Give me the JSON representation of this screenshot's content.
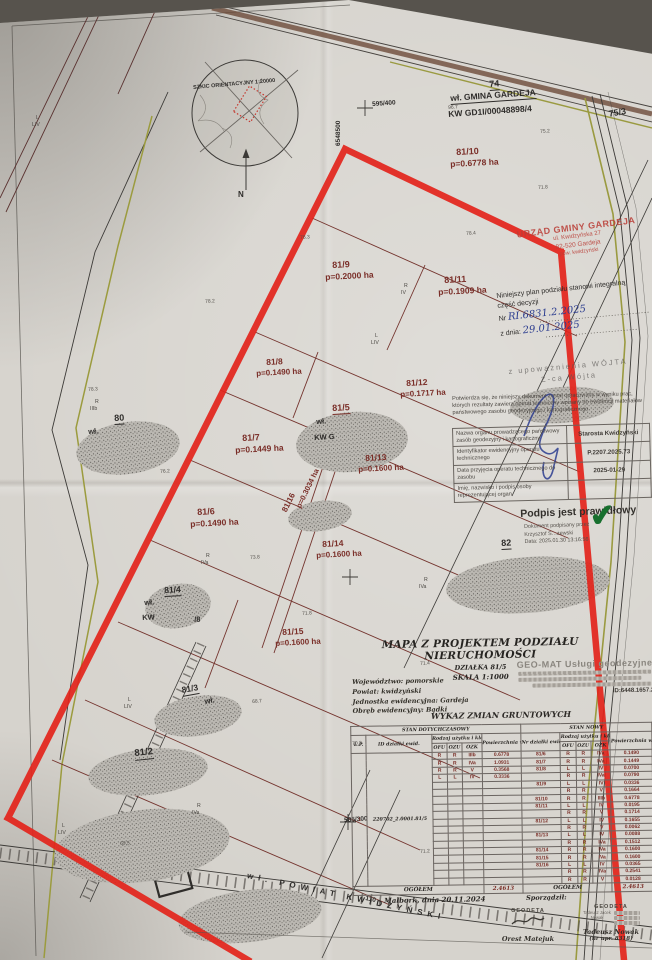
{
  "document": {
    "sketch": {
      "label": "SZKIC ORIENTACYJNY 1:20000",
      "north": "N"
    },
    "office_stamp": {
      "line1": "URZĄD GMINY GARDEJA",
      "line2": "ul. Kwidzyńska 27",
      "line3": "82-520 Gardeja",
      "line4": "pow. kwidzyński"
    },
    "decision": {
      "line1": "Niniejszy plan podziału stanowi integralną",
      "line2": "część decyzji",
      "nr_label": "Nr",
      "nr_value": "RI.6831.2.2025",
      "date_label": "z dnia:",
      "date_value": "29.01.2025",
      "auth1": "z upoważnienia WÓJTA",
      "auth2": "Z-ca Wójta"
    },
    "certification": {
      "note": "Potwierdza się, że niniejszy dokument został opracowany w wyniku prac, których rezultaty zawiera operat techniczny wpisany do ewidencji materiałów państwowego zasobu geodezyjnego i kartograficznego.",
      "rows": [
        {
          "label": "Nazwa organu prowadzącego państwowy zasób geodezyjny i kartograficzny",
          "value": "Starosta Kwidzyński"
        },
        {
          "label": "Identyfikator ewidencyjny operatu technicznego",
          "value": "P.2207.2025.73"
        },
        {
          "label": "Data przyjęcia operatu technicznego do zasobu",
          "value": "2025-01-29"
        },
        {
          "label": "Imię, nazwisko i podpis osoby reprezentującej organ",
          "value": ""
        }
      ],
      "signature_status": "Podpis jest prawidłowy",
      "signature_lines": [
        "Dokument podpisany przez",
        "Krzysztof S…żewski",
        "Data: 2025.01.30 13:16:56"
      ],
      "check_icon": "✔"
    },
    "title_block": {
      "title": "MAPA Z PROJEKTEM PODZIAŁU NIERUCHOMOŚCI",
      "subtitle1": "DZIAŁKA 81/5",
      "subtitle2": "SKALA 1:1000",
      "admin": [
        "Województwo: pomorskie",
        "Powiat: kwidzyński",
        "Jednostka ewidencyjna: Gardeja",
        "Obręb ewidencyjny: Bądki"
      ]
    },
    "geomat": {
      "name": "GEO-MAT Usługi geodezyjne",
      "id_line": "ID:6448.1657.20"
    },
    "table": {
      "title": "WYKAZ ZMIAN GRUNTOWYCH",
      "head": {
        "old_group": "STAN DOTYCHCZASOWY",
        "new_group": "STAN NOWY",
        "lp": "L.P.",
        "id": "ID działki ewid.",
        "usetype": "Rodzaj użytku i klas",
        "area": "Powierzchnia w ha",
        "nr": "Nr działki ewid.",
        "ofu": "OFU",
        "ozu": "OZU",
        "ozk": "OZK"
      },
      "lp": "1",
      "id": "220702_2.0001.81/5",
      "rows": [
        {
          "old": [
            "R",
            "R",
            "IIIb",
            "0.6778"
          ],
          "nr": "81/6",
          "n": [
            "R",
            "R",
            "IVa"
          ],
          "pow": "0.1490"
        },
        {
          "old": [
            "R",
            "R",
            "IVa",
            "1.0931"
          ],
          "nr": "81/7",
          "n": [
            "R",
            "R",
            "IVa"
          ],
          "pow": "0.1449"
        },
        {
          "old": [
            "R",
            "R",
            "V",
            "0.3568"
          ],
          "nr": "81/8",
          "n": [
            "L",
            "L",
            "IV"
          ],
          "pow": "0.0700"
        },
        {
          "old": [
            "L",
            "L",
            "IV",
            "0.3336"
          ],
          "nr": "",
          "n": [
            "R",
            "R",
            "IVa"
          ],
          "pow": "0.0790"
        },
        {
          "old": null,
          "nr": "81/9",
          "n": [
            "L",
            "L",
            "IV"
          ],
          "pow": "0.0336"
        },
        {
          "old": null,
          "nr": "",
          "n": [
            "R",
            "R",
            "V"
          ],
          "pow": "0.1664"
        },
        {
          "old": null,
          "nr": "81/10",
          "n": [
            "R",
            "R",
            "IIIb"
          ],
          "pow": "0.6778"
        },
        {
          "old": null,
          "nr": "81/11",
          "n": [
            "L",
            "L",
            "IV"
          ],
          "pow": "0.0195"
        },
        {
          "old": null,
          "nr": "",
          "n": [
            "R",
            "R",
            "V"
          ],
          "pow": "0.1714"
        },
        {
          "old": null,
          "nr": "81/12",
          "n": [
            "L",
            "L",
            "IV"
          ],
          "pow": "0.1655"
        },
        {
          "old": null,
          "nr": "",
          "n": [
            "R",
            "R",
            "V"
          ],
          "pow": "0.0062"
        },
        {
          "old": null,
          "nr": "81/13",
          "n": [
            "L",
            "L",
            "IV"
          ],
          "pow": "0.0088"
        },
        {
          "old": null,
          "nr": "",
          "n": [
            "R",
            "R",
            "IVa"
          ],
          "pow": "0.1512"
        },
        {
          "old": null,
          "nr": "81/14",
          "n": [
            "R",
            "R",
            "IVa"
          ],
          "pow": "0.1600"
        },
        {
          "old": null,
          "nr": "81/15",
          "n": [
            "R",
            "R",
            "IVa"
          ],
          "pow": "0.1600"
        },
        {
          "old": null,
          "nr": "81/16",
          "n": [
            "L",
            "L",
            "IV"
          ],
          "pow": "0.0365"
        },
        {
          "old": null,
          "nr": "",
          "n": [
            "R",
            "R",
            "IVa"
          ],
          "pow": "0.2541"
        },
        {
          "old": null,
          "nr": "",
          "n": [
            "R",
            "R",
            "V"
          ],
          "pow": "0.0128"
        }
      ],
      "total_label": "OGÓŁEM",
      "total_old": "2.4613",
      "total_new": "2.4613"
    },
    "footer": {
      "place_date": "Malbork, dnia 20.11.2024",
      "prepared_label": "Sporządził:"
    },
    "geodeta1": {
      "stamp": "GEODETA",
      "name": "Orest Matejuk"
    },
    "geodeta2": {
      "stamp": "GEODETA",
      "inner": "Tadeusz Jacek Nowak",
      "name": "Tadeusz Nowak",
      "license": "(nr upr. 8318)"
    },
    "colors": {
      "outline_red": "#e3241b",
      "stamp_red": "#ba3e37",
      "hand_blue": "#2b3c8f",
      "check_green": "#186f2e",
      "parcel_maroon": "#7a2e28"
    },
    "map_labels": [
      [
        "SZKIC ORIENTACYJNY 1:20000",
        193,
        86,
        -5,
        5.5,
        "b"
      ],
      [
        "N",
        238,
        191,
        0,
        8,
        "b"
      ],
      [
        "75/3",
        608,
        110,
        -10,
        9,
        "b"
      ],
      [
        "74",
        489,
        80,
        -4,
        9,
        "b",
        1
      ],
      [
        "wł. GMINA GARDEJA",
        450,
        94,
        -4,
        8.5,
        "b",
        1
      ],
      [
        "KW GD1I/00048898/4",
        448,
        110,
        -4,
        8.5,
        "b"
      ],
      [
        "595/400",
        372,
        102,
        -4,
        6.5,
        "b"
      ],
      [
        "6548500",
        336,
        146,
        -90,
        6.5,
        "b"
      ],
      [
        "81/10",
        456,
        148,
        -3,
        9,
        "m"
      ],
      [
        "p=0.6778 ha",
        450,
        160,
        -3,
        8.5,
        "m"
      ],
      [
        "81/9",
        332,
        261,
        -3,
        9,
        "m"
      ],
      [
        "p=0.2000 ha",
        325,
        273,
        -3,
        8.5,
        "m"
      ],
      [
        "81/11",
        444,
        276,
        -3,
        9,
        "m"
      ],
      [
        "p=0.1909 ha",
        438,
        288,
        -3,
        8.5,
        "m"
      ],
      [
        "81/8",
        266,
        358,
        -3,
        8.5,
        "m"
      ],
      [
        "p=0.1490 ha",
        256,
        370,
        -3,
        8,
        "m"
      ],
      [
        "81/12",
        406,
        379,
        -3,
        8.5,
        "m"
      ],
      [
        "p=0.1717 ha",
        400,
        391,
        -3,
        8,
        "m"
      ],
      [
        "81/5",
        332,
        404,
        -3,
        9,
        "m",
        1
      ],
      [
        "wł.",
        316,
        418,
        -3,
        7.5,
        "b"
      ],
      [
        "KW G",
        314,
        434,
        -3,
        7.5,
        "b"
      ],
      [
        "81/7",
        242,
        434,
        -3,
        9,
        "m"
      ],
      [
        "p=0.1449 ha",
        235,
        446,
        -3,
        8.5,
        "m"
      ],
      [
        "81/13",
        365,
        454,
        -3,
        8.5,
        "m"
      ],
      [
        "p=0.1600 ha",
        358,
        466,
        -3,
        8,
        "m"
      ],
      [
        "81/16",
        281,
        510,
        -64,
        8,
        "m"
      ],
      [
        "p=0.3034 ha",
        295,
        506,
        -64,
        7.5,
        "m"
      ],
      [
        "81/6",
        197,
        508,
        -3,
        9,
        "m"
      ],
      [
        "p=0.1490 ha",
        190,
        520,
        -3,
        8.5,
        "m"
      ],
      [
        "81/14",
        322,
        540,
        -3,
        8.5,
        "m"
      ],
      [
        "p=0.1600 ha",
        316,
        552,
        -3,
        8,
        "m"
      ],
      [
        "80",
        114,
        414,
        -3,
        9,
        "b",
        1
      ],
      [
        "wł.",
        88,
        428,
        -3,
        7.5,
        "b"
      ],
      [
        "81/4",
        164,
        586,
        -3,
        8.5,
        "b",
        1
      ],
      [
        "wł.",
        144,
        599,
        -3,
        7.5,
        "b"
      ],
      [
        "KW",
        142,
        614,
        -3,
        7.5,
        "b"
      ],
      [
        "/8",
        194,
        616,
        -3,
        7.5,
        "b"
      ],
      [
        "81/15",
        282,
        628,
        -3,
        8.5,
        "m"
      ],
      [
        "p=0.1600 ha",
        275,
        640,
        -3,
        8,
        "m"
      ],
      [
        "81/3",
        181,
        686,
        -10,
        8.5,
        "b",
        1
      ],
      [
        "wł.",
        204,
        698,
        -10,
        7.5,
        "b"
      ],
      [
        "81/2",
        134,
        749,
        -6,
        9.5,
        "b",
        1
      ],
      [
        "82",
        501,
        539,
        -3,
        9,
        "b",
        1
      ],
      [
        "585/300",
        344,
        818,
        -4,
        6.5,
        "b"
      ],
      [
        "wł. POWIAT KWIDZYŃSKI",
        248,
        872,
        12,
        8,
        "b",
        0,
        5
      ],
      [
        "110",
        366,
        896,
        12,
        6.5,
        "b"
      ],
      [
        "R",
        95,
        400,
        0,
        5.2,
        "s"
      ],
      [
        "IIIb",
        90,
        407,
        0,
        5.2,
        "s"
      ],
      [
        "R",
        206,
        554,
        0,
        5.2,
        "s"
      ],
      [
        "IVa",
        201,
        561,
        0,
        5.2,
        "s"
      ],
      [
        "R",
        424,
        578,
        0,
        5.2,
        "s"
      ],
      [
        "IVa",
        419,
        585,
        0,
        5.2,
        "s"
      ],
      [
        "L",
        375,
        334,
        0,
        5.2,
        "s"
      ],
      [
        "LIV",
        371,
        341,
        0,
        5.2,
        "s"
      ],
      [
        "R",
        404,
        284,
        0,
        5.2,
        "s"
      ],
      [
        "IV",
        401,
        291,
        0,
        5.2,
        "s"
      ],
      [
        "L",
        36,
        116,
        0,
        5.2,
        "s"
      ],
      [
        "LIV",
        32,
        123,
        0,
        5.2,
        "s"
      ],
      [
        "L",
        128,
        698,
        0,
        5.2,
        "s"
      ],
      [
        "LIV",
        124,
        705,
        0,
        5.2,
        "s"
      ],
      [
        "L",
        62,
        824,
        0,
        5.2,
        "s"
      ],
      [
        "LIV",
        58,
        831,
        0,
        5.2,
        "s"
      ],
      [
        "R",
        197,
        804,
        0,
        5.2,
        "s"
      ],
      [
        "IVa",
        192,
        811,
        0,
        5.2,
        "s"
      ],
      [
        "96.7",
        448,
        106,
        -4,
        5,
        "p"
      ],
      [
        "75.2",
        540,
        130,
        -4,
        5,
        "p"
      ],
      [
        "71.8",
        538,
        186,
        -4,
        5,
        "p"
      ],
      [
        "78.4",
        466,
        232,
        -4,
        5,
        "p"
      ],
      [
        "76.3",
        300,
        236,
        -4,
        5,
        "p"
      ],
      [
        "78.2",
        205,
        300,
        -4,
        5,
        "p"
      ],
      [
        "78.3",
        88,
        388,
        -4,
        5,
        "p"
      ],
      [
        "76.2",
        160,
        470,
        -4,
        5,
        "p"
      ],
      [
        "73.8",
        250,
        556,
        -4,
        5,
        "p"
      ],
      [
        "71.8",
        302,
        612,
        -4,
        5,
        "p"
      ],
      [
        "71.4",
        420,
        662,
        -4,
        5,
        "p"
      ],
      [
        "68.7",
        252,
        700,
        -4,
        5,
        "p"
      ],
      [
        "70.3",
        352,
        742,
        -4,
        5,
        "p"
      ],
      [
        "71.2",
        420,
        850,
        -4,
        5,
        "p"
      ],
      [
        "69.5",
        120,
        842,
        -4,
        5,
        "p"
      ]
    ]
  }
}
